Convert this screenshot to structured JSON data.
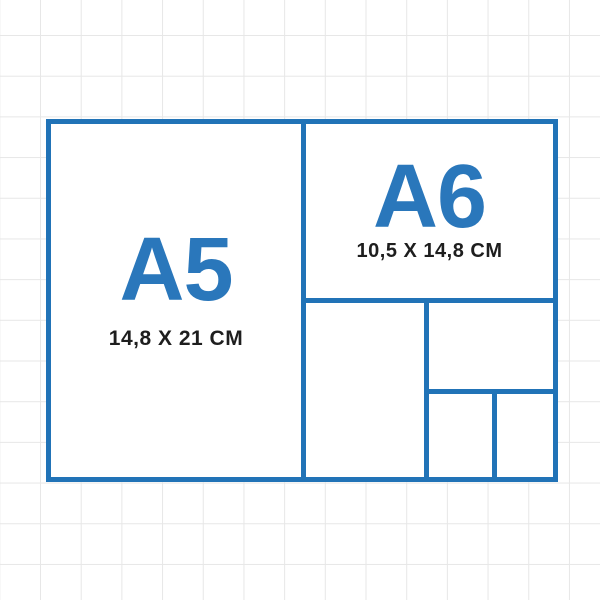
{
  "colors": {
    "accent": "#2173b7",
    "label_blue": "#2a77bb",
    "text_dark": "#1e1e1e",
    "grid_line": "#e7e7e7",
    "background": "#ffffff"
  },
  "diagram": {
    "type": "paper-size-comparison",
    "panels": [
      {
        "id": "a5",
        "label": "A5",
        "dimensions": "14,8 X 21 CM"
      },
      {
        "id": "a6",
        "label": "A6",
        "dimensions": "10,5 X 14,8 CM"
      },
      {
        "id": "a7",
        "label": ""
      },
      {
        "id": "a8",
        "label": ""
      },
      {
        "id": "a9-left",
        "label": ""
      },
      {
        "id": "a9-right",
        "label": ""
      }
    ]
  }
}
